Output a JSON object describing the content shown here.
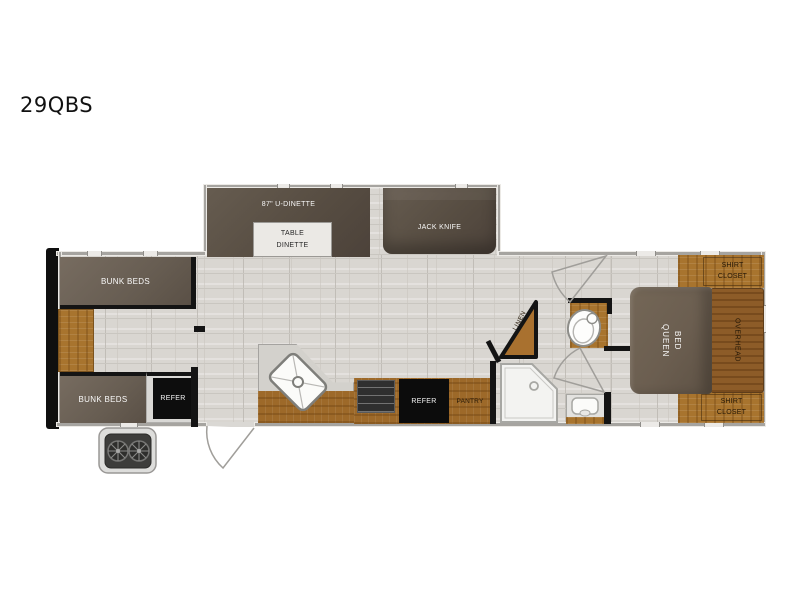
{
  "title": "29QBS",
  "labels": {
    "bunk_top": "BUNK BEDS",
    "bunk_bottom": "BUNK BEDS",
    "refer_bunk": "REFER",
    "dinette": "87\" U-DINETTE",
    "table_line1": "TABLE",
    "table_line2": "DINETTE",
    "sofa": "JACK KNIFE",
    "refer_kitchen": "REFER",
    "pantry": "PANTRY",
    "linen": "LINEN",
    "queen_line1": "QUEEN",
    "queen_line2": "BED",
    "overhead": "OVERHEAD",
    "shirt_top_line1": "SHIRT",
    "shirt_top_line2": "CLOSET",
    "shirt_bottom_line1": "SHIRT",
    "shirt_bottom_line2": "CLOSET"
  },
  "colors": {
    "wood": "#a8742e",
    "furniture_dark": "#574d42",
    "bunk": "#675d52",
    "appliance_black": "#0d0d0d",
    "floor": "#d9d6d1",
    "exterior_wall": "#a6a4a0",
    "interior_wall": "#141414",
    "front_cap": "#0f0f0f"
  }
}
